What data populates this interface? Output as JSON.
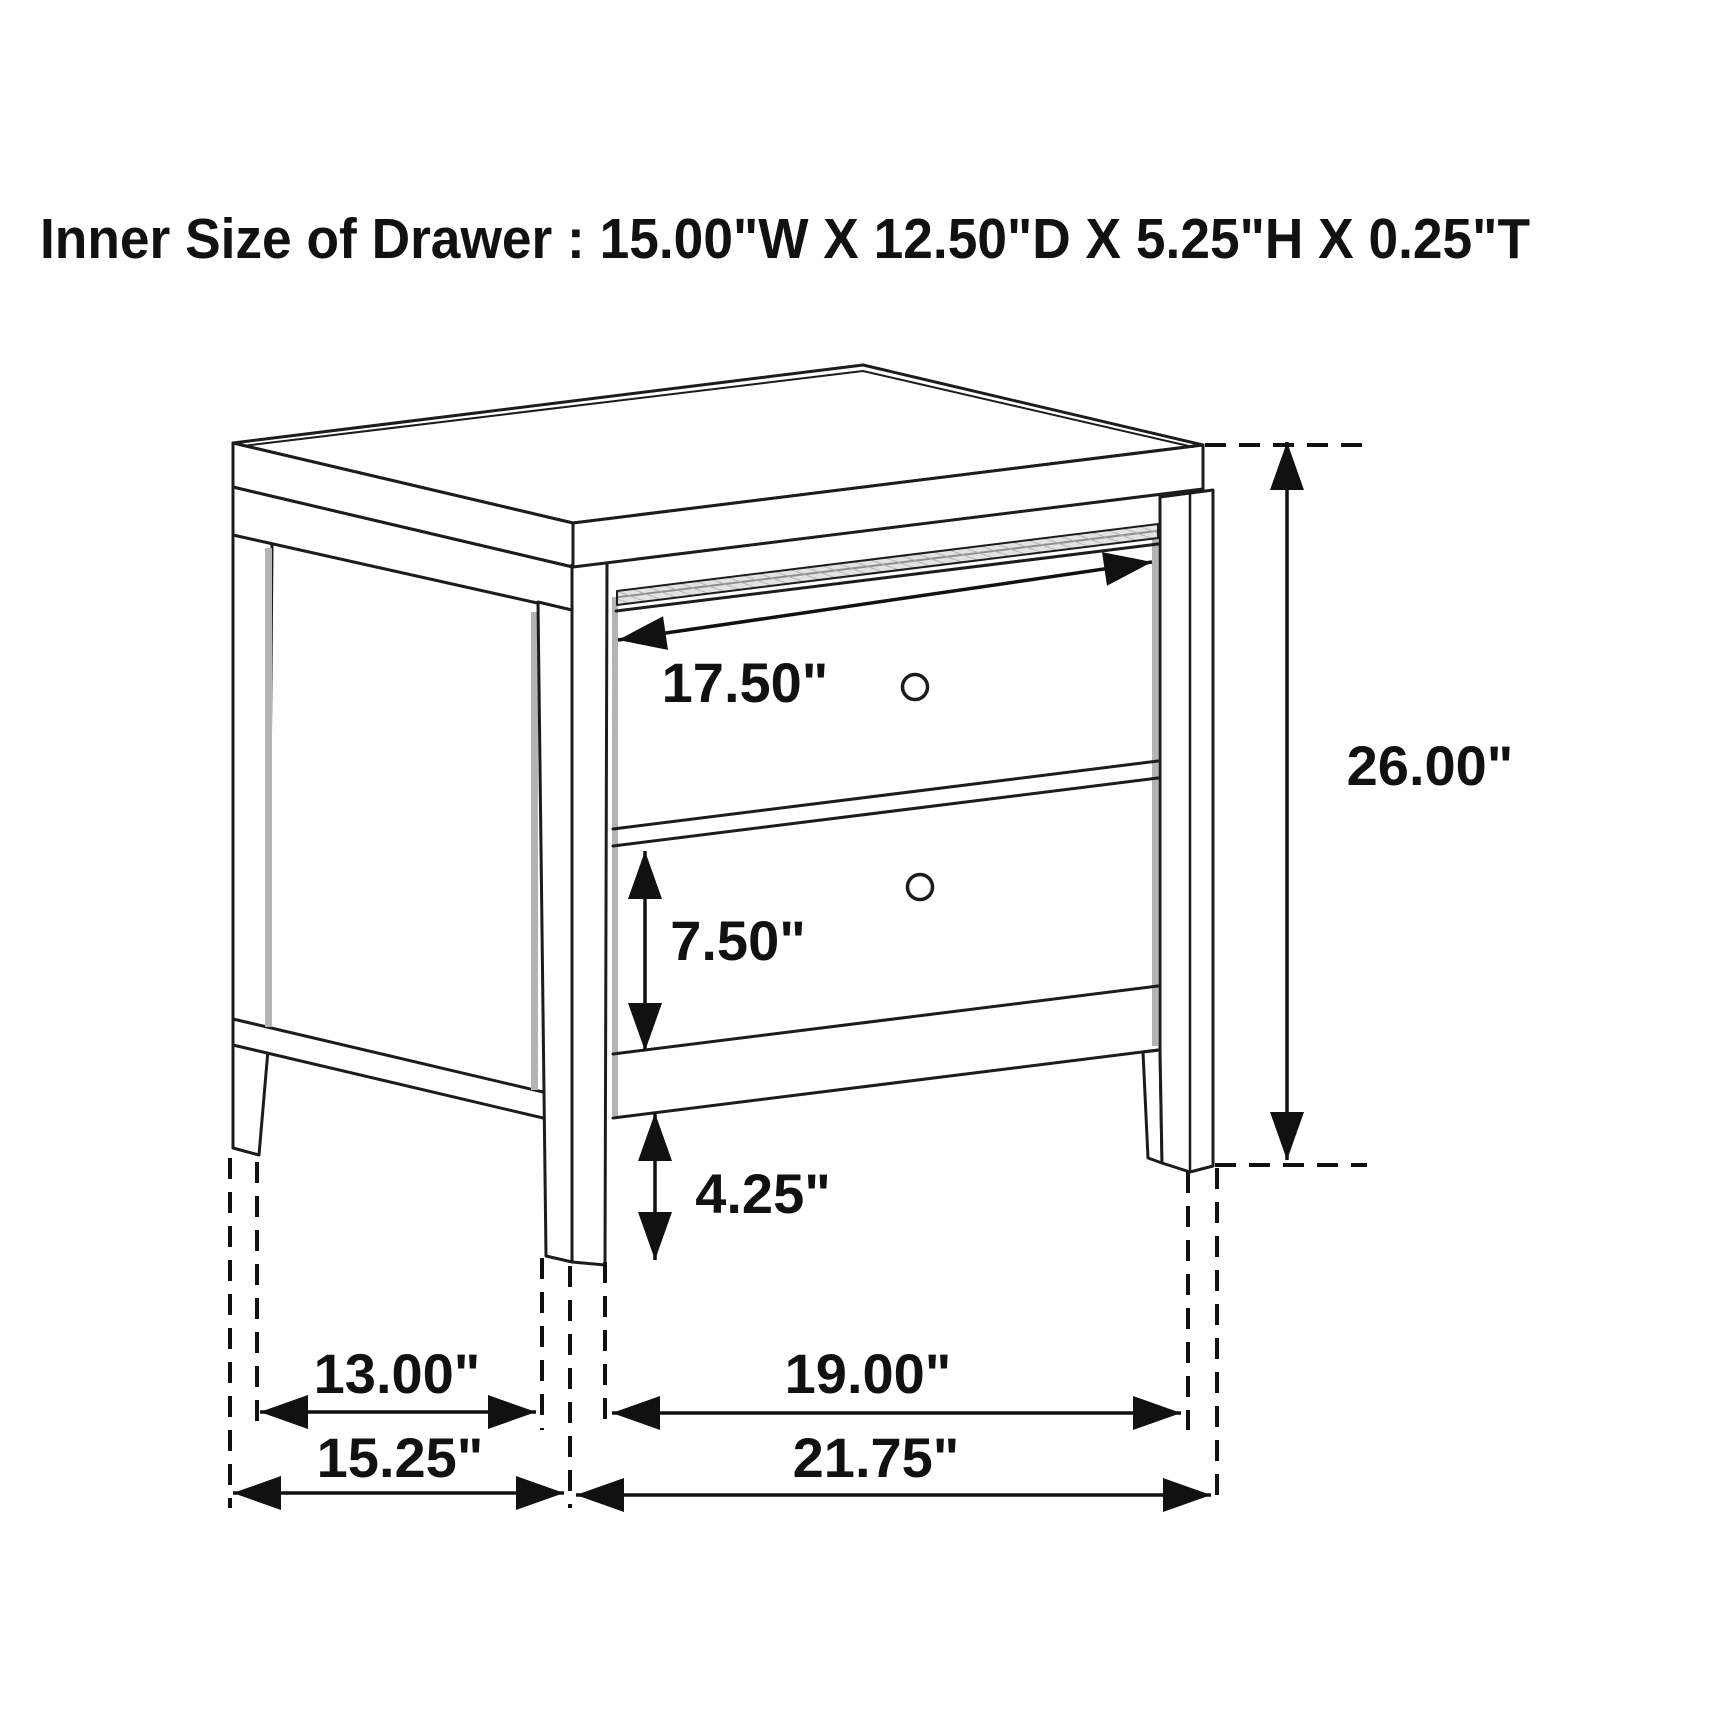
{
  "title": "Inner Size of Drawer : 15.00\"W X 12.50\"D X 5.25\"H X 0.25\"T",
  "diagram": {
    "subject": "two-drawer nightstand technical line drawing, three-quarter view",
    "style": "black line art with double-headed dimension arrows and dashed extension lines",
    "labels": {
      "drawer_width": "17.50\"",
      "overall_height": "26.00\"",
      "bottom_drawer_height": "7.50\"",
      "leg_clearance": "4.25\"",
      "side_inner_span": "13.00\"",
      "side_overall_depth": "15.25\"",
      "front_inner_span": "19.00\"",
      "front_overall_width": "21.75\""
    },
    "inner_drawer": {
      "width_in": 15.0,
      "depth_in": 12.5,
      "height_in": 5.25,
      "thickness_in": 0.25
    },
    "colors": {
      "line": "#1c1c1c",
      "background": "#ffffff",
      "shade": "#b4b4b4",
      "dim": "#111111"
    }
  }
}
